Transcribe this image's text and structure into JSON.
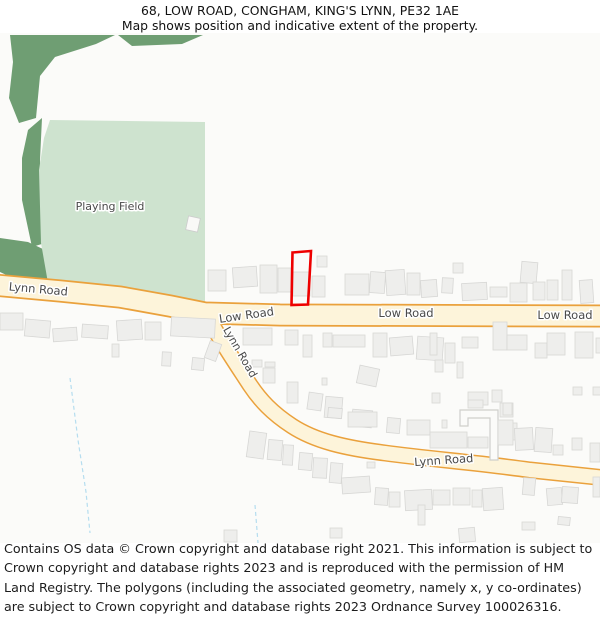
{
  "header": {
    "line1": "68, LOW ROAD, CONGHAM, KING'S LYNN, PE32 1AE",
    "line2": "Map shows position and indicative extent of the property."
  },
  "footer": {
    "text": "Contains OS data © Crown copyright and database right 2021. This information is subject to Crown copyright and database rights 2023 and is reproduced with the permission of HM Land Registry. The polygons (including the associated geometry, namely x, y co-ordinates) are subject to Crown copyright and database rights 2023 Ordnance Survey 100026316."
  },
  "map": {
    "colors": {
      "background": "#fbfbf9",
      "green_dark": "#6f9e73",
      "green_light": "#cee3cf",
      "road_fill": "#fdf4da",
      "road_casing": "#eaa13c",
      "building_fill": "#eeeeec",
      "building_stroke": "#d7d7d5",
      "white_building_fill": "#f9f9f7",
      "white_building_stroke": "#cccccc",
      "stream": "#b5ddef",
      "driveway_fill": "#fbfbf9",
      "driveway_stroke": "#cfcfcb",
      "property_outline": "#ee0000",
      "label": "#4a4a4a"
    },
    "green_dark_areas": [
      "10,35 115,35 96,44 55,57 40,76 36,118 19,123 9,98 13,62",
      "118,35 203,35 182,44 132,46",
      "28,130 42,118 40,160 42,210 45,243 32,247 22,200 22,158",
      "0,238 28,242 45,250 49,283 34,288 0,272"
    ],
    "green_light_areas": [
      "50,120 205,122 205,303 120,290 48,283 41,243 39,170 44,138"
    ],
    "streams": [
      "M 70 378 L 78 440 L 86 492 L 90 533",
      "M 255 505 L 258 543"
    ],
    "roads": [
      {
        "name": "low-road",
        "d": "M -6 285 L 60 291 L 120 297 L 170 306 L 205 313 L 280 315 L 606 316",
        "width": 19.5,
        "casing": 23
      },
      {
        "name": "lynn-road-south",
        "d": "M 207 315 C 220 340 235 362 250 385 C 260 400 272 413 292 426 C 315 441 345 448 385 453 C 430 459 480 463 530 470 L 606 478",
        "width": 14,
        "casing": 17
      }
    ],
    "driveway": "460,410 498,410 498,460 490,460 490,418 468,418 468,426 460,426",
    "buildings": [
      [
        208,
        270,
        18,
        21,
        0
      ],
      [
        233,
        267,
        24,
        20,
        -4
      ],
      [
        260,
        265,
        17,
        28,
        0
      ],
      [
        278,
        268,
        13,
        24,
        0
      ],
      [
        293,
        272,
        17,
        24,
        0
      ],
      [
        312,
        276,
        13,
        21,
        0
      ],
      [
        317,
        256,
        10,
        11,
        0
      ],
      [
        345,
        274,
        24,
        21,
        0
      ],
      [
        370,
        272,
        15,
        21,
        4
      ],
      [
        386,
        270,
        19,
        25,
        -4
      ],
      [
        407,
        273,
        13,
        22,
        0
      ],
      [
        421,
        280,
        16,
        17,
        -4
      ],
      [
        442,
        278,
        11,
        15,
        3
      ],
      [
        453,
        263,
        10,
        10,
        0
      ],
      [
        462,
        283,
        25,
        17,
        -3
      ],
      [
        490,
        287,
        17,
        10,
        0
      ],
      [
        510,
        283,
        17,
        19,
        0
      ],
      [
        521,
        262,
        16,
        21,
        5
      ],
      [
        533,
        282,
        12,
        18,
        0
      ],
      [
        547,
        280,
        11,
        20,
        0
      ],
      [
        562,
        270,
        10,
        30,
        0
      ],
      [
        580,
        280,
        13,
        23,
        -4
      ],
      [
        0,
        313,
        23,
        17,
        0
      ],
      [
        25,
        320,
        25,
        17,
        5
      ],
      [
        53,
        328,
        24,
        13,
        -4
      ],
      [
        82,
        325,
        26,
        13,
        4
      ],
      [
        117,
        320,
        25,
        20,
        -4
      ],
      [
        145,
        322,
        16,
        18,
        0
      ],
      [
        171,
        318,
        44,
        19,
        3
      ],
      [
        112,
        344,
        7,
        13,
        0
      ],
      [
        162,
        352,
        9,
        14,
        3
      ],
      [
        207,
        342,
        12,
        18,
        20
      ],
      [
        192,
        358,
        12,
        12,
        6
      ],
      [
        243,
        328,
        29,
        17,
        0
      ],
      [
        285,
        330,
        13,
        15,
        0
      ],
      [
        303,
        335,
        9,
        22,
        0
      ],
      [
        323,
        333,
        9,
        14,
        0
      ],
      [
        333,
        335,
        32,
        12,
        0
      ],
      [
        373,
        333,
        14,
        24,
        0
      ],
      [
        390,
        337,
        23,
        18,
        -5
      ],
      [
        417,
        337,
        26,
        23,
        4
      ],
      [
        430,
        333,
        7,
        22,
        0
      ],
      [
        445,
        343,
        10,
        20,
        0
      ],
      [
        462,
        337,
        16,
        11,
        0
      ],
      [
        493,
        322,
        14,
        28,
        0
      ],
      [
        507,
        335,
        20,
        15,
        0
      ],
      [
        535,
        343,
        12,
        15,
        0
      ],
      [
        547,
        333,
        18,
        22,
        0
      ],
      [
        575,
        332,
        18,
        26,
        0
      ],
      [
        596,
        338,
        8,
        15,
        0
      ],
      [
        435,
        360,
        8,
        12,
        0
      ],
      [
        457,
        362,
        6,
        16,
        0
      ],
      [
        573,
        387,
        9,
        8,
        0
      ],
      [
        593,
        387,
        9,
        8,
        0
      ],
      [
        432,
        393,
        8,
        10,
        0
      ],
      [
        468,
        392,
        20,
        13,
        0
      ],
      [
        492,
        390,
        10,
        12,
        0
      ],
      [
        500,
        403,
        13,
        14,
        0
      ],
      [
        507,
        423,
        10,
        17,
        0
      ],
      [
        252,
        360,
        10,
        7,
        0
      ],
      [
        265,
        362,
        10,
        5,
        0
      ],
      [
        263,
        368,
        12,
        15,
        0
      ],
      [
        287,
        382,
        11,
        21,
        0
      ],
      [
        308,
        393,
        14,
        17,
        8
      ],
      [
        322,
        378,
        5,
        7,
        0
      ],
      [
        325,
        397,
        17,
        21,
        5
      ],
      [
        358,
        367,
        20,
        18,
        12
      ],
      [
        352,
        410,
        20,
        17,
        5
      ],
      [
        328,
        408,
        14,
        10,
        5
      ],
      [
        348,
        412,
        29,
        15,
        0
      ],
      [
        387,
        418,
        13,
        15,
        5
      ],
      [
        407,
        420,
        23,
        15,
        0
      ],
      [
        442,
        420,
        5,
        8,
        0
      ],
      [
        430,
        432,
        37,
        16,
        0
      ],
      [
        468,
        437,
        20,
        11,
        0
      ],
      [
        468,
        400,
        15,
        8,
        0
      ],
      [
        503,
        403,
        9,
        12,
        0
      ],
      [
        498,
        420,
        15,
        25,
        0
      ],
      [
        515,
        428,
        18,
        22,
        -3
      ],
      [
        535,
        428,
        17,
        24,
        4
      ],
      [
        553,
        445,
        10,
        10,
        0
      ],
      [
        572,
        438,
        10,
        12,
        0
      ],
      [
        590,
        443,
        10,
        19,
        0
      ],
      [
        248,
        432,
        17,
        26,
        8
      ],
      [
        268,
        440,
        14,
        20,
        5
      ],
      [
        283,
        445,
        10,
        20,
        3
      ],
      [
        299,
        453,
        13,
        17,
        5
      ],
      [
        313,
        458,
        14,
        20,
        3
      ],
      [
        330,
        463,
        12,
        20,
        5
      ],
      [
        342,
        477,
        28,
        16,
        -4
      ],
      [
        367,
        462,
        8,
        6,
        0
      ],
      [
        375,
        488,
        13,
        17,
        4
      ],
      [
        389,
        492,
        11,
        15,
        0
      ],
      [
        405,
        490,
        27,
        20,
        -3
      ],
      [
        418,
        505,
        7,
        20,
        0
      ],
      [
        433,
        490,
        17,
        15,
        0
      ],
      [
        453,
        488,
        17,
        17,
        0
      ],
      [
        472,
        490,
        10,
        17,
        0
      ],
      [
        483,
        488,
        20,
        22,
        -4
      ],
      [
        523,
        478,
        12,
        17,
        5
      ],
      [
        547,
        488,
        15,
        17,
        -5
      ],
      [
        562,
        487,
        16,
        16,
        4
      ],
      [
        558,
        517,
        12,
        8,
        6
      ],
      [
        522,
        522,
        13,
        8,
        0
      ],
      [
        593,
        477,
        7,
        20,
        0
      ],
      [
        224,
        530,
        13,
        12,
        0
      ],
      [
        459,
        528,
        16,
        14,
        -5
      ],
      [
        330,
        528,
        12,
        10,
        0
      ]
    ],
    "white_buildings": [
      [
        187,
        217,
        12,
        14,
        12
      ]
    ],
    "labels": [
      {
        "text": "Playing Field",
        "x": 110,
        "y": 210,
        "rot": 0,
        "size": 11,
        "color": "#4f4f4f"
      },
      {
        "text": "Lynn Road",
        "x": 38,
        "y": 293,
        "rot": 5,
        "size": 11.5,
        "color": "#4a4a4a"
      },
      {
        "text": "Low Road",
        "x": 247,
        "y": 319,
        "rot": -8,
        "size": 11.5,
        "color": "#4a4a4a"
      },
      {
        "text": "Low Road",
        "x": 406,
        "y": 317,
        "rot": 0,
        "size": 11.5,
        "color": "#4a4a4a"
      },
      {
        "text": "Low Road",
        "x": 565,
        "y": 319,
        "rot": 0,
        "size": 11.5,
        "color": "#4a4a4a"
      },
      {
        "text": "Lynn Road",
        "x": 237,
        "y": 354,
        "rot": 60,
        "size": 11,
        "color": "#4a4a4a"
      },
      {
        "text": "Lynn Road",
        "x": 444,
        "y": 464,
        "rot": -4,
        "size": 11.5,
        "color": "#4a4a4a"
      }
    ],
    "property_outline": {
      "points": "292.5,252.5 311,251 308,304.5 291.5,305",
      "stroke_width": 2.6
    }
  }
}
